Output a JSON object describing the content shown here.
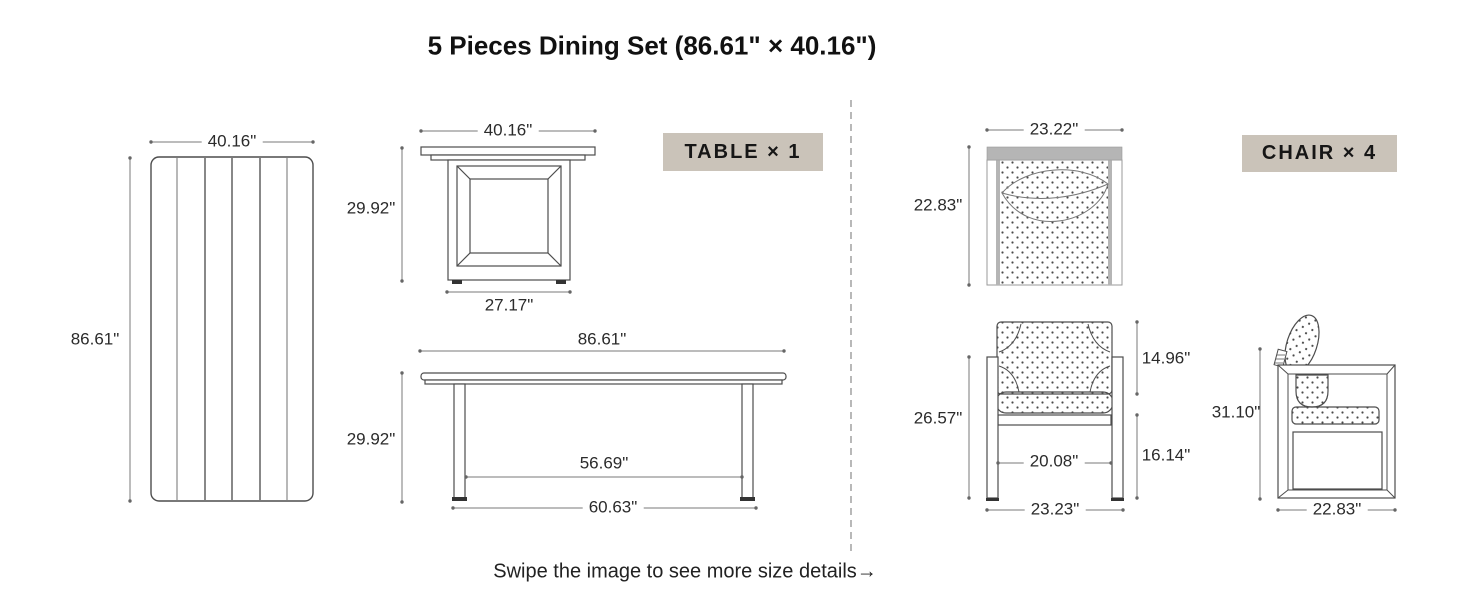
{
  "title": "5 Pieces Dining Set (86.61\" × 40.16\")",
  "footer": {
    "note": "Swipe the image to see more size details→"
  },
  "colors": {
    "badge_bg": "#cac3b9",
    "outline": "#4d4d4d",
    "dimension_line": "#7a7a7a",
    "chair_back_bar": "#b5b5b5",
    "background": "#ffffff"
  },
  "table": {
    "badge": "TABLE × 1",
    "top_view": {
      "width": "40.16\"",
      "length": "86.61\""
    },
    "end_view": {
      "top_width": "40.16\"",
      "height": "29.92\"",
      "base_width": "27.17\""
    },
    "side_view": {
      "length": "86.61\"",
      "height": "29.92\"",
      "leg_span_inner": "56.69\"",
      "leg_span_outer": "60.63\""
    }
  },
  "chair": {
    "badge": "CHAIR × 4",
    "top_view": {
      "width": "23.22\"",
      "depth": "22.83\""
    },
    "front_view": {
      "arm_height": "26.57\"",
      "back_cushion_height": "14.96\"",
      "seat_frame_height": "16.14\"",
      "inner_width": "20.08\"",
      "overall_width": "23.23\""
    },
    "side_view": {
      "overall_height": "31.10\"",
      "depth": "22.83\""
    }
  }
}
